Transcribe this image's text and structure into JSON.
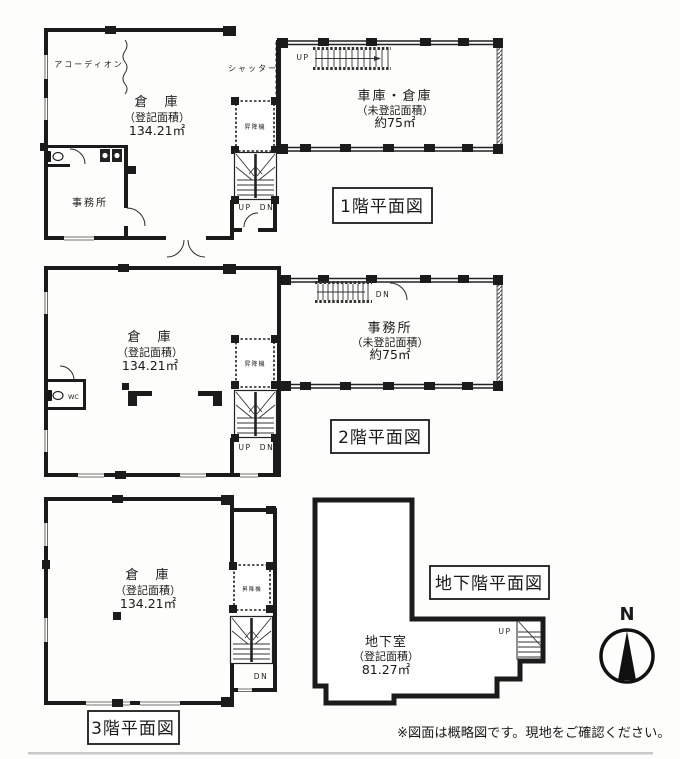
{
  "floor1": {
    "title": "1階平面図",
    "warehouse": {
      "name": "倉　庫",
      "note": "（登記面積）",
      "area": "134.21㎡"
    },
    "garage": {
      "name": "車庫・倉庫",
      "note": "（未登記面積）",
      "area": "約75㎡"
    },
    "office_label": "事務所",
    "accordion_label": "アコーディオン",
    "shutter_label": "シャッター",
    "elevator_label": "昇降機",
    "stair_up": "UP",
    "stair_dn": "DN",
    "ladder_label": "UP"
  },
  "floor2": {
    "title": "2階平面図",
    "warehouse": {
      "name": "倉　庫",
      "note": "（登記面積）",
      "area": "134.21㎡"
    },
    "office": {
      "name": "事務所",
      "note": "（未登記面積）",
      "area": "約75㎡"
    },
    "wc_label": "WC",
    "elevator_label": "昇降機",
    "stair_up": "UP",
    "stair_dn": "DN",
    "ladder_label": "DN"
  },
  "floor3": {
    "title": "3階平面図",
    "warehouse": {
      "name": "倉　庫",
      "note": "（登記面積）",
      "area": "134.21㎡"
    },
    "elevator_label": "昇降機",
    "stair_dn": "DN"
  },
  "basement": {
    "title": "地下階平面図",
    "room": {
      "name": "地下室",
      "note": "（登記面積）",
      "area": "81.27㎡"
    },
    "stair_up": "UP"
  },
  "compass": {
    "north": "N"
  },
  "footer": {
    "disclaimer": "※図面は概略図です。現地をご確認ください。"
  }
}
